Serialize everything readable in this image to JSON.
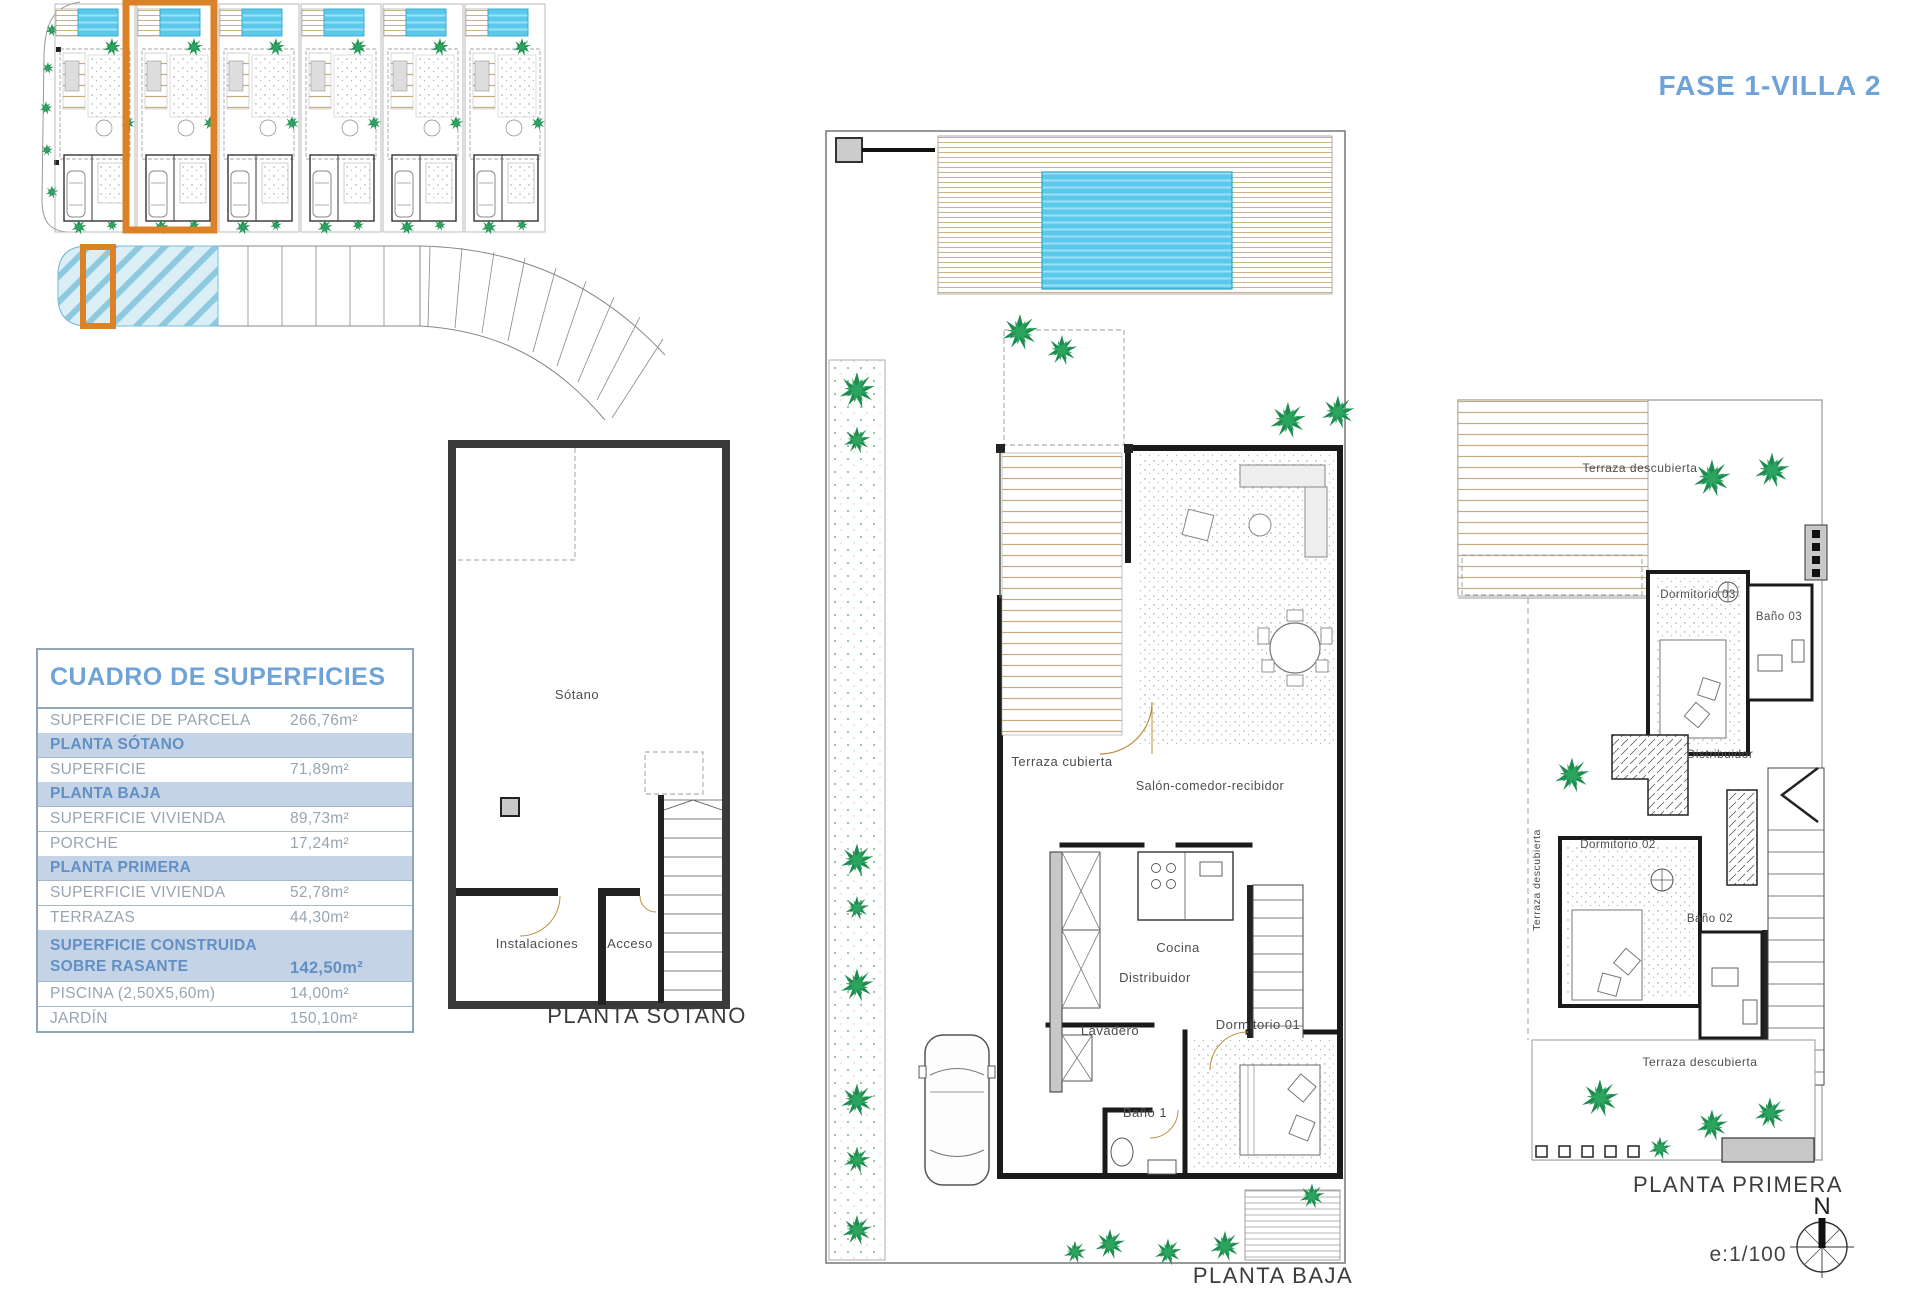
{
  "title": "FASE 1-VILLA 2",
  "colors": {
    "accent_blue": "#6FA3D8",
    "section_bg": "#C4D3E5",
    "table_border": "#8FA6BA",
    "data_text": "#97A5B2",
    "highlight_orange": "#DB8127",
    "pool_cyan": "#5AC9EC",
    "hatch_cyan": "#8ECADF",
    "tree_green": "#1F8B4F",
    "wall_gray": "#C8C8C8"
  },
  "surfaces_table": {
    "title": "CUADRO DE SUPERFICIES",
    "rows": [
      {
        "label": "SUPERFICIE DE PARCELA",
        "value": "266,76m²",
        "type": "data"
      },
      {
        "label": "PLANTA SÓTANO",
        "value": "",
        "type": "section"
      },
      {
        "label": "SUPERFICIE",
        "value": "71,89m²",
        "type": "data"
      },
      {
        "label": "PLANTA BAJA",
        "value": "",
        "type": "section"
      },
      {
        "label": "SUPERFICIE VIVIENDA",
        "value": "89,73m²",
        "type": "data"
      },
      {
        "label": "PORCHE",
        "value": "17,24m²",
        "type": "data"
      },
      {
        "label": "PLANTA PRIMERA",
        "value": "",
        "type": "section"
      },
      {
        "label": "SUPERFICIE VIVIENDA",
        "value": "52,78m²",
        "type": "data"
      },
      {
        "label": "TERRAZAS",
        "value": "44,30m²",
        "type": "data"
      },
      {
        "label": "SUPERFICIE CONSTRUIDA SOBRE RASANTE",
        "value": "142,50m²",
        "type": "total"
      },
      {
        "label": "PISCINA (2,50X5,60m)",
        "value": "14,00m²",
        "type": "data"
      },
      {
        "label": "JARDÍN",
        "value": "150,10m²",
        "type": "data"
      }
    ]
  },
  "plan_labels": {
    "sotano": "PLANTA SÓTANO",
    "baja": "PLANTA BAJA",
    "primera": "PLANTA PRIMERA"
  },
  "rooms": {
    "sotano": "Sótano",
    "instalaciones": "Instalaciones",
    "acceso": "Acceso",
    "terraza_cubierta": "Terraza cubierta",
    "salon": "Salón-comedor-recibidor",
    "cocina": "Cocina",
    "distribuidor_pb": "Distribuidor",
    "lavadero": "Lavadero",
    "dormitorio01": "Dormitorio 01",
    "bano1": "Baño 1",
    "terraza_desc_top": "Terraza descubierta",
    "dormitorio03": "Dormitorio 03",
    "bano03": "Baño 03",
    "distribuidor_p1": "Distribuidor",
    "dormitorio02": "Dormitorio 02",
    "bano02": "Baño 02",
    "terraza_desc_left": "Terraza descubierta",
    "terraza_desc_bottom": "Terraza descubierta"
  },
  "scale_label": "e:1/100",
  "north_label": "N"
}
